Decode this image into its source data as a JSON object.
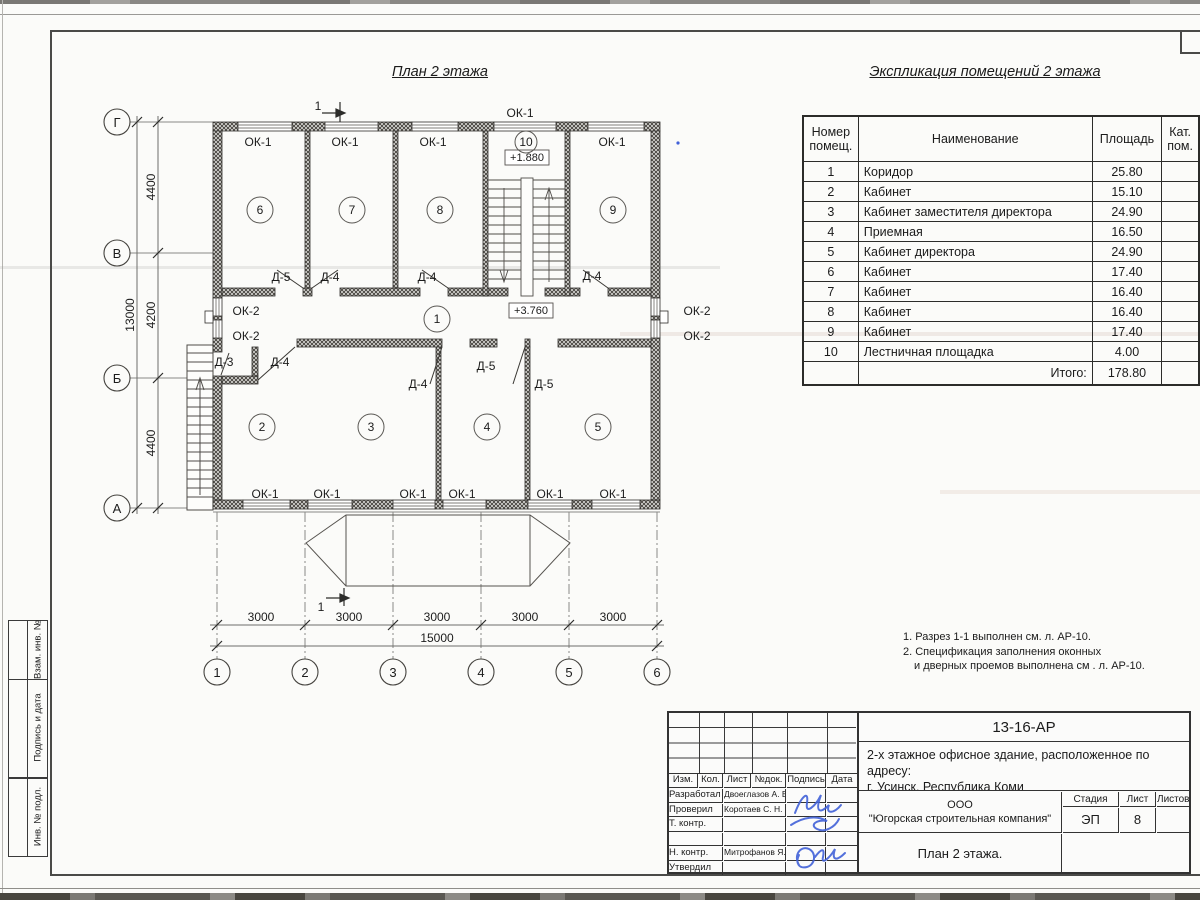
{
  "plan": {
    "title": "План 2 этажа",
    "section_label": "1",
    "axis_rows": [
      "Г",
      "В",
      "Б",
      "А"
    ],
    "axis_cols": [
      "1",
      "2",
      "3",
      "4",
      "5",
      "6"
    ],
    "dim_rows": [
      "4400",
      "4200",
      "4400"
    ],
    "dim_rows_total": "13000",
    "dim_cols": [
      "3000",
      "3000",
      "3000",
      "3000",
      "3000"
    ],
    "dim_cols_total": "15000",
    "rooms": [
      "1",
      "2",
      "3",
      "4",
      "5",
      "6",
      "7",
      "8",
      "9",
      "10"
    ],
    "levels": {
      "stair_landing": "+1.880",
      "corridor": "+3.760"
    },
    "window_types": {
      "ok1": "ОК-1",
      "ok2": "ОК-2"
    },
    "door_types": {
      "d3": "Д-3",
      "d4": "Д-4",
      "d5": "Д-5"
    }
  },
  "schedule": {
    "title": "Экспликация помещений 2 этажа",
    "headers": {
      "number_line1": "Номер",
      "number_line2": "помещ.",
      "name": "Наименование",
      "area": "Площадь",
      "cat_line1": "Кат.",
      "cat_line2": "пом."
    },
    "rows": [
      {
        "num": "1",
        "name": "Коридор",
        "area": "25.80"
      },
      {
        "num": "2",
        "name": "Кабинет",
        "area": "15.10"
      },
      {
        "num": "3",
        "name": "Кабинет заместителя директора",
        "area": "24.90"
      },
      {
        "num": "4",
        "name": "Приемная",
        "area": "16.50"
      },
      {
        "num": "5",
        "name": "Кабинет директора",
        "area": "24.90"
      },
      {
        "num": "6",
        "name": "Кабинет",
        "area": "17.40"
      },
      {
        "num": "7",
        "name": "Кабинет",
        "area": "16.40"
      },
      {
        "num": "8",
        "name": "Кабинет",
        "area": "16.40"
      },
      {
        "num": "9",
        "name": "Кабинет",
        "area": "17.40"
      },
      {
        "num": "10",
        "name": "Лестничная площадка",
        "area": "4.00"
      }
    ],
    "total_label": "Итого:",
    "total_value": "178.80"
  },
  "notes": {
    "line1": "1. Разрез 1-1 выполнен см. л. АР-10.",
    "line2": "2. Спецификация заполнения оконных",
    "line3": "и дверных проемов выполнена см . л. АР-10."
  },
  "titleblock": {
    "doc_number": "13-16-АР",
    "project_line1": "2-х этажное офисное здание, расположенное по адресу:",
    "project_line2": "г. Усинск, Республика Коми",
    "org_line1": "ООО",
    "org_line2": "\"Югорская строительная компания\"",
    "sheet_title": "План 2 этажа.",
    "stage_label": "Стадия",
    "stage_value": "ЭП",
    "sheet_label": "Лист",
    "sheet_value": "8",
    "sheets_label": "Листов",
    "cols": {
      "izm": "Изм.",
      "kol": "Кол.",
      "list": "Лист",
      "ndoc": "№док.",
      "sign": "Подпись",
      "date": "Дата"
    },
    "roles": [
      {
        "label": "Разработал",
        "name": "Двоеглазов А. В."
      },
      {
        "label": "Проверил",
        "name": "Коротаев С. Н."
      },
      {
        "label": "Т. контр.",
        "name": ""
      },
      {
        "label": "",
        "name": ""
      },
      {
        "label": "Н. контр.",
        "name": "Митрофанов Я. А."
      },
      {
        "label": "Утвердил",
        "name": ""
      }
    ]
  },
  "side_stamp": {
    "labels": [
      "Взам. инв. №",
      "Подпись и дата",
      "Инв. № подл."
    ]
  },
  "colors": {
    "ink": "#1c1c1c",
    "signature_blue": "#4161d8"
  }
}
